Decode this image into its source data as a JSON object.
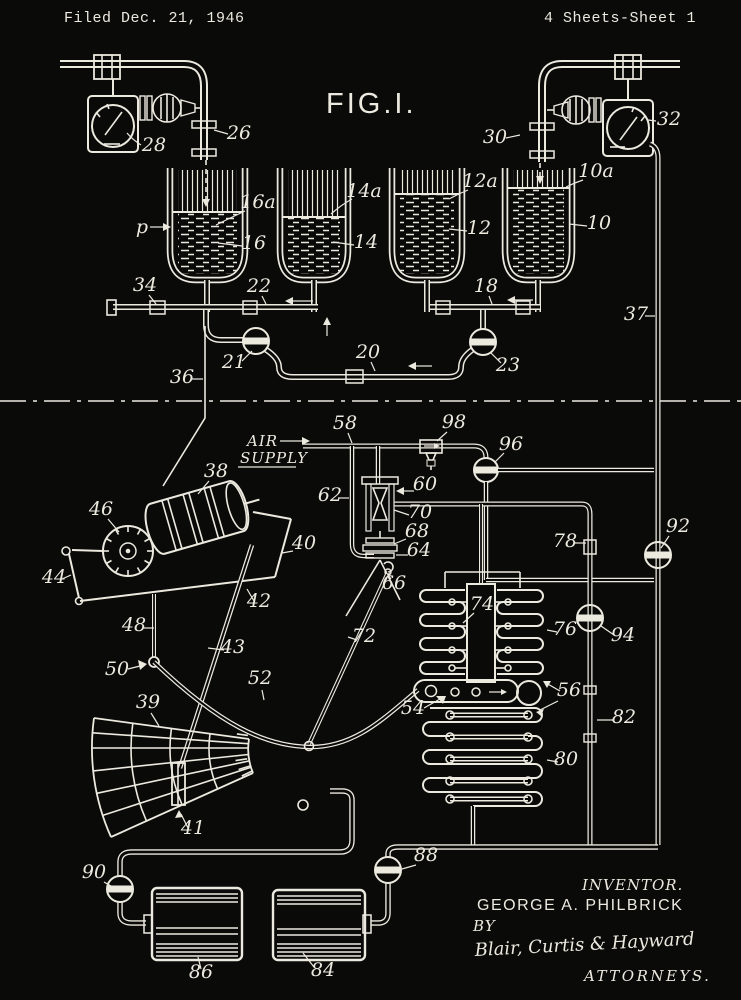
{
  "header": {
    "filed_label": "Filed Dec. 21, 1946",
    "sheet_label": "4 Sheets-Sheet 1"
  },
  "figure": {
    "title": "FIG.I."
  },
  "annotations": {
    "air_line1": "AIR",
    "air_line2": "SUPPLY",
    "pressure": "p"
  },
  "credits": {
    "inventor_heading": "INVENTOR.",
    "inventor_name": "GEORGE A. PHILBRICK",
    "by_label": "BY",
    "signature": "Blair, Curtis & Hayward",
    "attorneys_label": "ATTORNEYS."
  },
  "colors": {
    "background": "#0a0a09",
    "ink": "#ece9df"
  },
  "refs": {
    "r10": "10",
    "r10a": "10a",
    "r12": "12",
    "r12a": "12a",
    "r14": "14",
    "r14a": "14a",
    "r16": "16",
    "r16a": "16a",
    "r18": "18",
    "r20": "20",
    "r21": "21",
    "r22": "22",
    "r23": "23",
    "r26": "26",
    "r28": "28",
    "r30": "30",
    "r32": "32",
    "r34": "34",
    "r36": "36",
    "r37": "37",
    "r38": "38",
    "r39": "39",
    "r40": "40",
    "r41": "41",
    "r42": "42",
    "r43": "43",
    "r44": "44",
    "r46": "46",
    "r48": "48",
    "r50": "50",
    "r52": "52",
    "r54": "54",
    "r56": "56",
    "r58": "58",
    "r60": "60",
    "r62": "62",
    "r64": "64",
    "r66": "66",
    "r68": "68",
    "r70": "70",
    "r72": "72",
    "r74": "74",
    "r76": "76",
    "r78": "78",
    "r80": "80",
    "r82": "82",
    "r84": "84",
    "r86": "86",
    "r88": "88",
    "r90": "90",
    "r92": "92",
    "r94": "94",
    "r96": "96",
    "r98": "98"
  }
}
